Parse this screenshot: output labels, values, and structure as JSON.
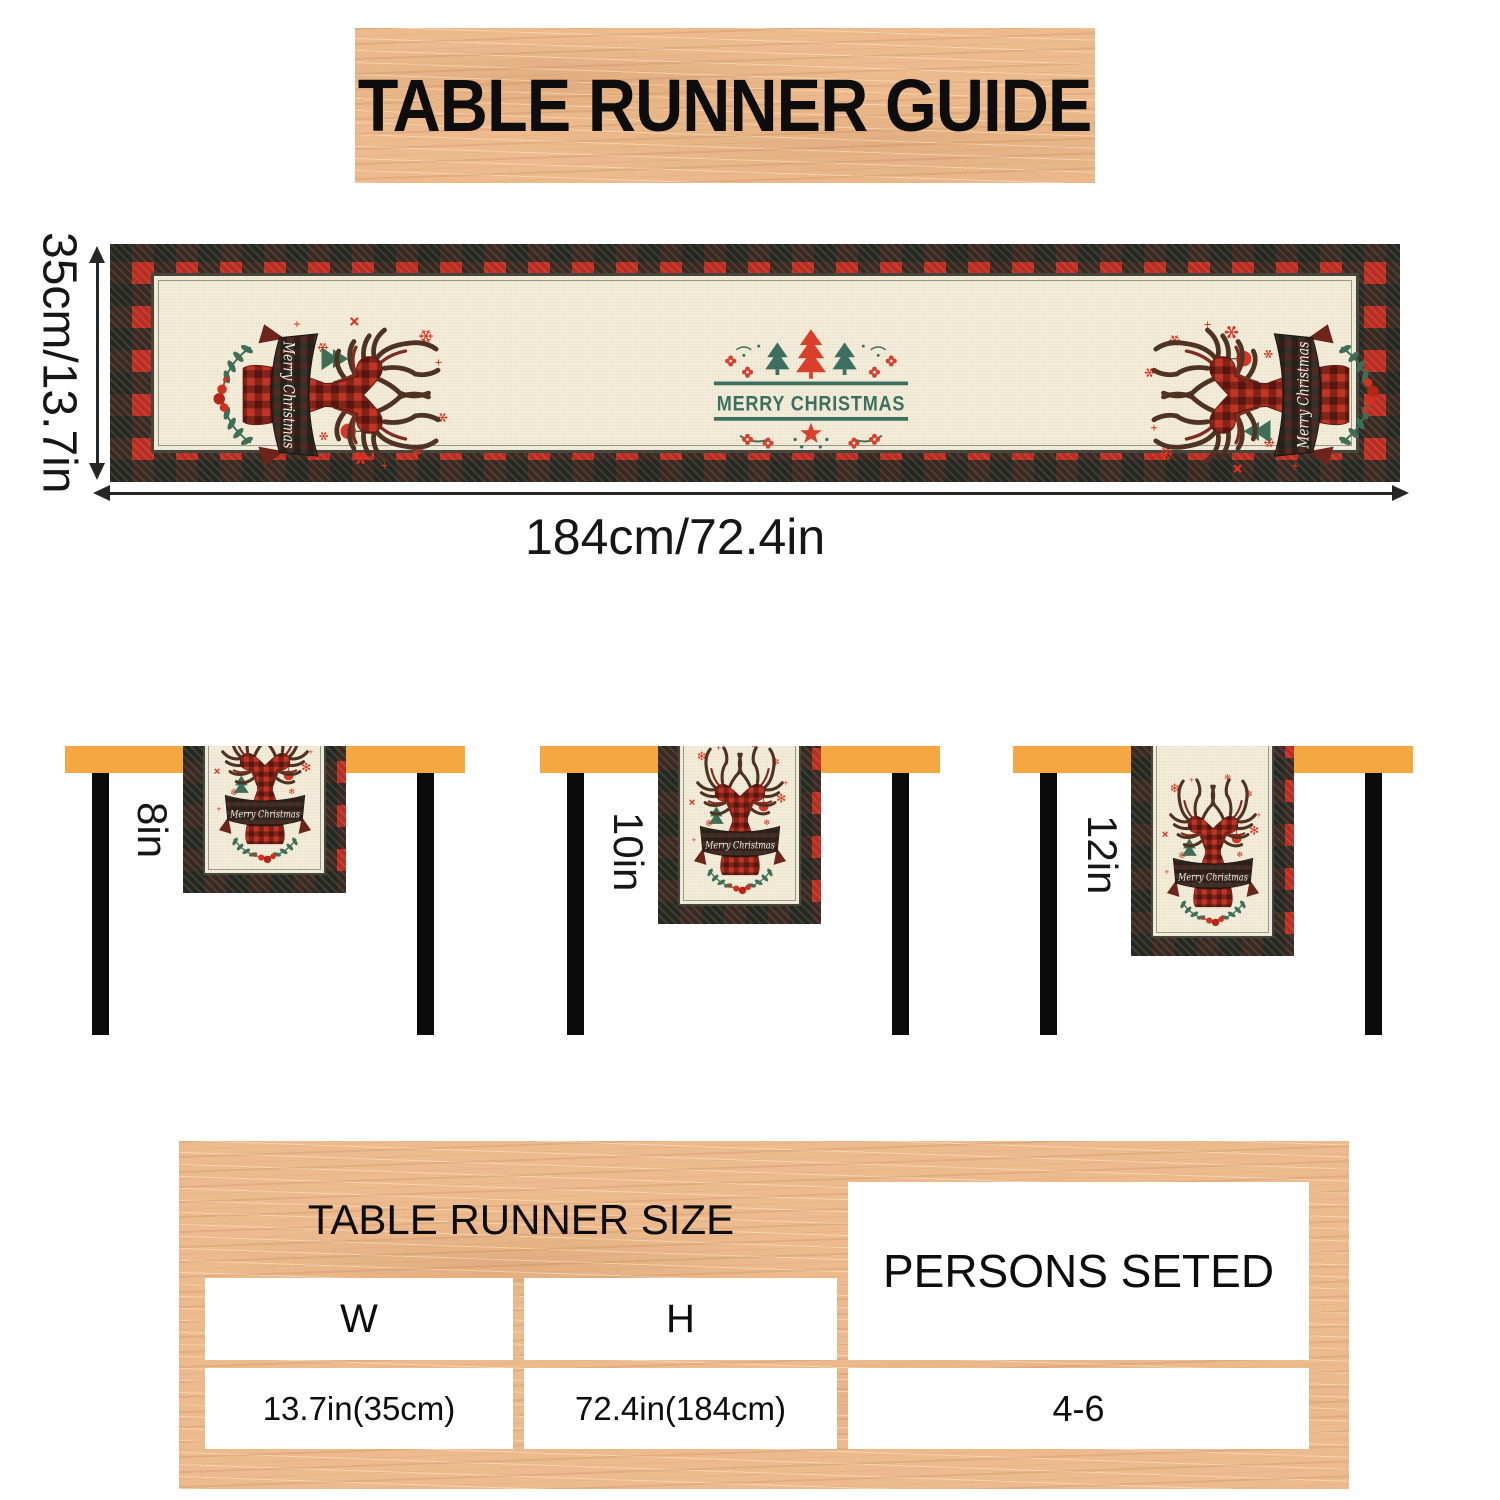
{
  "banner": {
    "title": "TABLE RUNNER GUIDE"
  },
  "runner_diagram": {
    "height_dimension": "35cm/13.7in",
    "width_dimension": "184cm/72.4in",
    "center_motif_text": "MERRY CHRISTMAS",
    "ribbon_script_text": "Merry Christmas"
  },
  "drop_tables": [
    {
      "drop_label": "8in"
    },
    {
      "drop_label": "10in"
    },
    {
      "drop_label": "12in"
    }
  ],
  "spec_table": {
    "title": "TABLE RUNNER SIZE",
    "col_w_header": "W",
    "col_h_header": "H",
    "persons_header": "PERSONS SETED",
    "w_value": "13.7in(35cm)",
    "h_value": "72.4in(184cm)",
    "persons_value": "4-6"
  },
  "colors": {
    "wood": "#ecba8c",
    "table_top_orange": "#f5a842",
    "plaid_red": "#bb2d20",
    "plaid_dark": "#222820",
    "runner_cream": "#f3edda",
    "motif_green": "#3c6f60",
    "accent_red": "#e0311f",
    "leg_black": "#0b0b0b"
  }
}
